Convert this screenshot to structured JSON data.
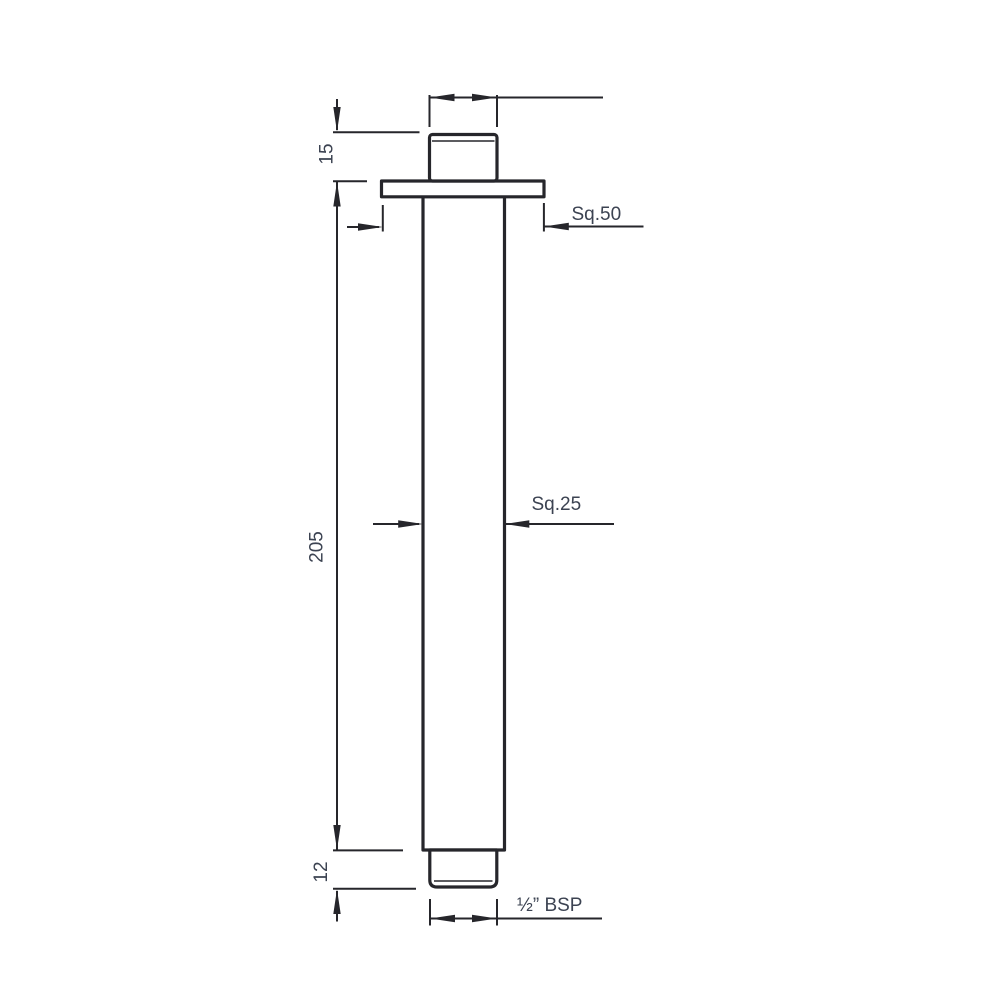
{
  "drawing": {
    "title": "ceiling-mounted square shower arm technical drawing",
    "background": "#ffffff",
    "line_color": "#26262b",
    "text_color": "#3c4352",
    "labels": {
      "top_connector_height": "15",
      "arm_length": "205",
      "bottom_thread_length": "12",
      "flange_size": "Sq.50",
      "tube_size": "Sq.25",
      "thread_spec": "½” BSP"
    }
  }
}
